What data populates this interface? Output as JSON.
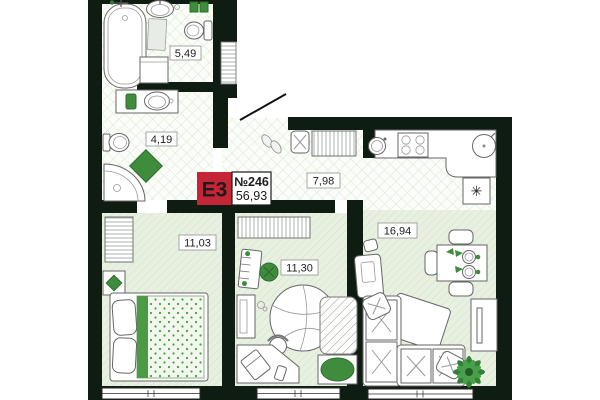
{
  "unit": {
    "badge_code": "E3",
    "unit_number": "№246",
    "total_area": "56,93",
    "areas": {
      "bathroom_large": "5,49",
      "bathroom_small": "4,19",
      "hall_kitchen": "7,98",
      "bedroom": "11,03",
      "kids_room": "11,30",
      "living_room": "16,94"
    },
    "icons": {
      "vent_symbol": "✳"
    },
    "colors": {
      "wall": "#0e1c11",
      "badge_red": "#c52637",
      "accent_green": "#3f8d3c",
      "accent_green_dark": "#2c6b2e",
      "tile_line": "#d8e7d0",
      "parquet_bg": "#e8f0e1",
      "parquet_line": "#d2e2c7"
    }
  }
}
